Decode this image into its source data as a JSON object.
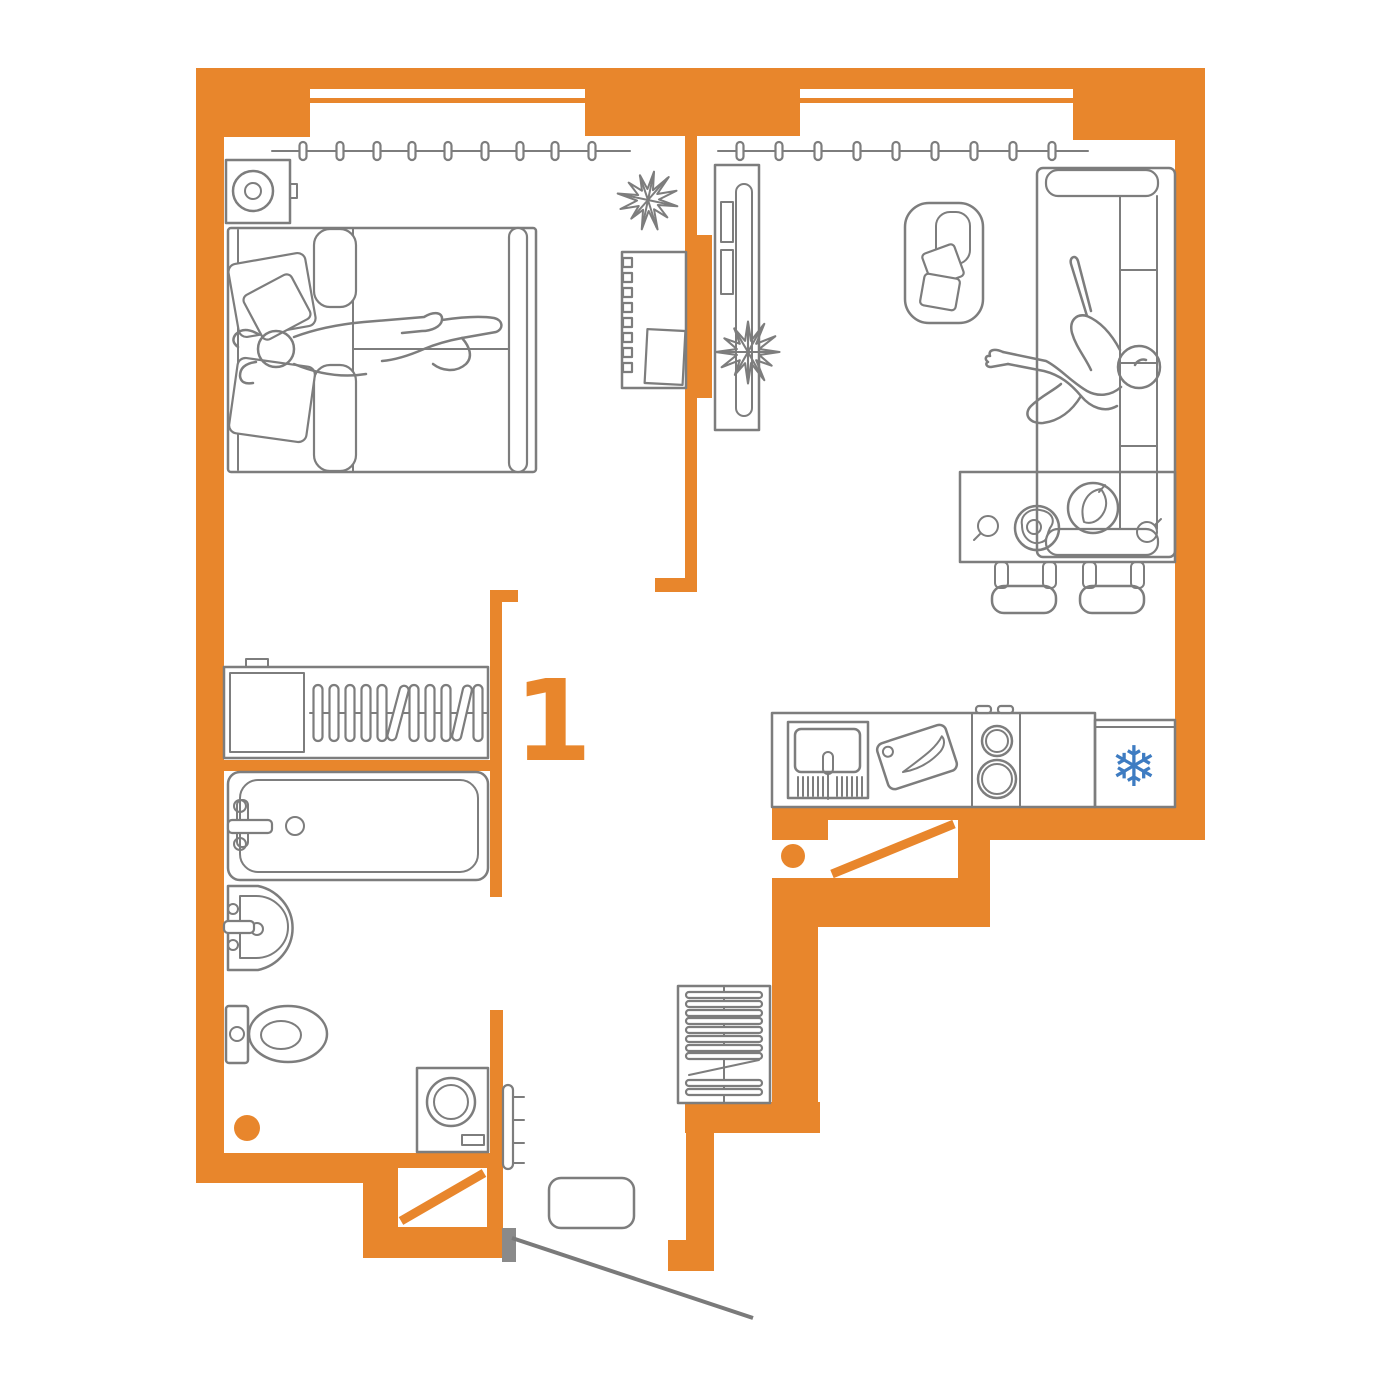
{
  "unit_label": "1",
  "icons": {
    "freezer": "❄"
  },
  "colors": {
    "wall": "#E8862C",
    "line": "#7D7D7D",
    "swing": "#7A7A7A",
    "accent_blue": "#3E7CC2",
    "bg": "#FFFFFF"
  }
}
